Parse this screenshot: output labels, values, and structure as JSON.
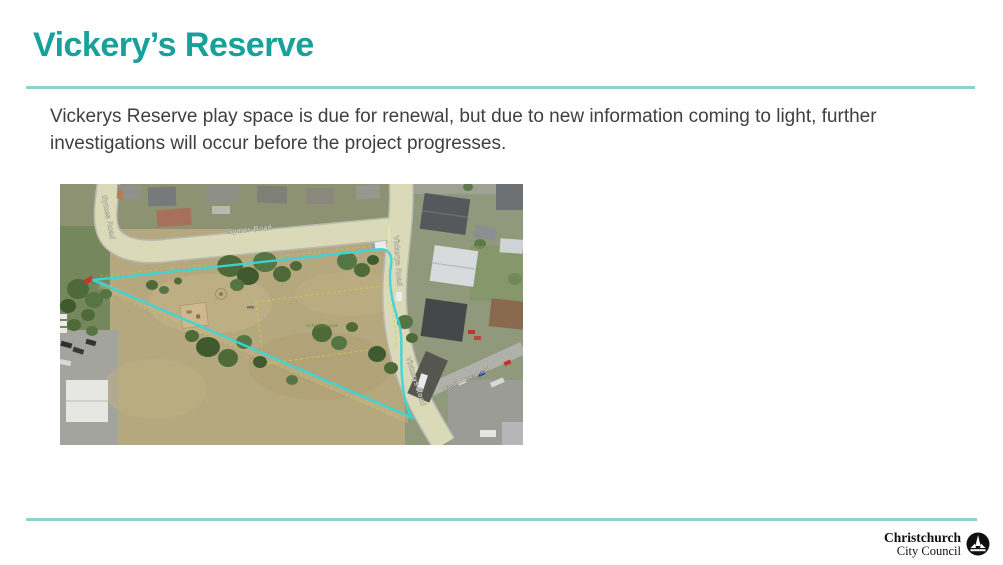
{
  "slide": {
    "title": "Vickery’s Reserve",
    "body": "Vickerys Reserve play space is due for renewal, but due to new information coming to light, further investigations will occur before the project progresses."
  },
  "map": {
    "description": "Aerial photo of Vickerys Reserve with cyan boundary outline",
    "labels": {
      "symes_road_vertical": "Symes Road",
      "symes_road": "Symes Road",
      "vickerys_road_upper": "Vickerys Road",
      "vickerys_road_lower": "Vickerys Road",
      "washbournes_road": "Washbournes Road",
      "reserve": "Vickerys Reserve"
    },
    "boundary_color": "#3bd5d8",
    "road_highlight_color": "#ebebbc"
  },
  "footer": {
    "logo_line1": "Christchurch",
    "logo_line2": "City Council"
  },
  "colors": {
    "accent": "#18a09a",
    "rule": "#8fd2cc",
    "body_text": "#3f3f3f"
  }
}
